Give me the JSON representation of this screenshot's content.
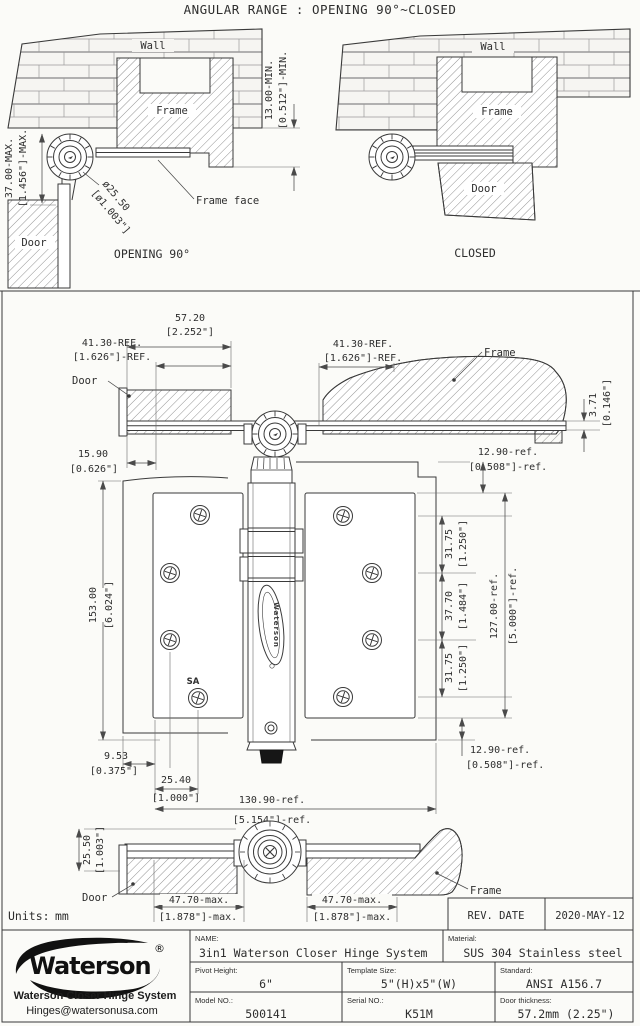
{
  "colors": {
    "background": "#fbfbf8",
    "line": "#3a3a3a",
    "logo": "#111111"
  },
  "drawing": {
    "title": "ANGULAR RANGE : OPENING 90°~CLOSED",
    "units_label": "Units:",
    "units_value": "mm"
  },
  "view_opening": {
    "wall": "Wall",
    "frame": "Frame",
    "door": "Door",
    "frame_face": "Frame face",
    "caption": "OPENING 90°",
    "dim_offset_mm": "37.00-MAX.",
    "dim_offset_in": "[1.456\"]-MAX.",
    "dim_inset_mm": "13.00-MIN.",
    "dim_inset_in": "[0.512\"]-MIN.",
    "dim_dia_mm": "ø25.50",
    "dim_dia_in": "[ø1.003\"]"
  },
  "view_closed": {
    "wall": "Wall",
    "frame": "Frame",
    "door": "Door",
    "caption": "CLOSED"
  },
  "view_top": {
    "door": "Door",
    "frame": "Frame",
    "dim_57_mm": "57.20",
    "dim_57_in": "[2.252\"]",
    "dim_41L_mm": "41.30-REF.",
    "dim_41L_in": "[1.626\"]-REF.",
    "dim_41R_mm": "41.30-REF.",
    "dim_41R_in": "[1.626\"]-REF.",
    "dim_3_mm": "3.71",
    "dim_3_in": "[0.146\"]",
    "dim_15_mm": "15.90",
    "dim_15_in": "[0.626\"]"
  },
  "view_front": {
    "dim_153_mm": "153.00",
    "dim_153_in": "[6.024\"]",
    "dim_129T_mm": "12.90-ref.",
    "dim_129T_in": "[0.508\"]-ref.",
    "dim_3175a_mm": "31.75",
    "dim_3175a_in": "[1.250\"]",
    "dim_377_mm": "37.70",
    "dim_377_in": "[1.484\"]",
    "dim_3175b_mm": "31.75",
    "dim_3175b_in": "[1.250\"]",
    "dim_127_mm": "127.00-ref.",
    "dim_127_in": "[5.000\"]-ref.",
    "dim_129B_mm": "12.90-ref.",
    "dim_129B_in": "[0.508\"]-ref.",
    "dim_953_mm": "9.53",
    "dim_953_in": "[0.375\"]",
    "dim_254_mm": "25.40",
    "dim_254_in": "[1.000\"]",
    "dim_1309_mm": "130.90-ref.",
    "dim_1309_in": "[5.154\"]-ref.",
    "sa_mark": "SA",
    "logo_vertical": "Waterson"
  },
  "view_bottom": {
    "door": "Door",
    "frame": "Frame",
    "dim_255_mm": "25.50",
    "dim_255_in": "[1.003\"]",
    "dim_477L_mm": "47.70-max.",
    "dim_477L_in": "[1.878\"]-max.",
    "dim_477R_mm": "47.70-max.",
    "dim_477R_in": "[1.878\"]-max."
  },
  "title_block": {
    "rev_label": "REV. DATE",
    "rev_date": "2020-MAY-12",
    "logo_text": "Waterson",
    "logo_reg": "®",
    "company": "Waterson Closer Hinge System",
    "email": "Hinges@watersonusa.com",
    "name_label": "NAME:",
    "name_value": "3in1 Waterson Closer Hinge System",
    "material_label": "Material:",
    "material_value": "SUS 304 Stainless steel",
    "pivot_label": "Pivot Height:",
    "pivot_value": "6\"",
    "template_label": "Template Size:",
    "template_value": "5\"(H)x5\"(W)",
    "standard_label": "Standard:",
    "standard_value": "ANSI A156.7",
    "model_label": "Model NO.:",
    "model_value": "500141",
    "serial_label": "Serial NO.:",
    "serial_value": "K51M",
    "thickness_label": "Door thickness:",
    "thickness_value": "57.2mm (2.25\")"
  }
}
